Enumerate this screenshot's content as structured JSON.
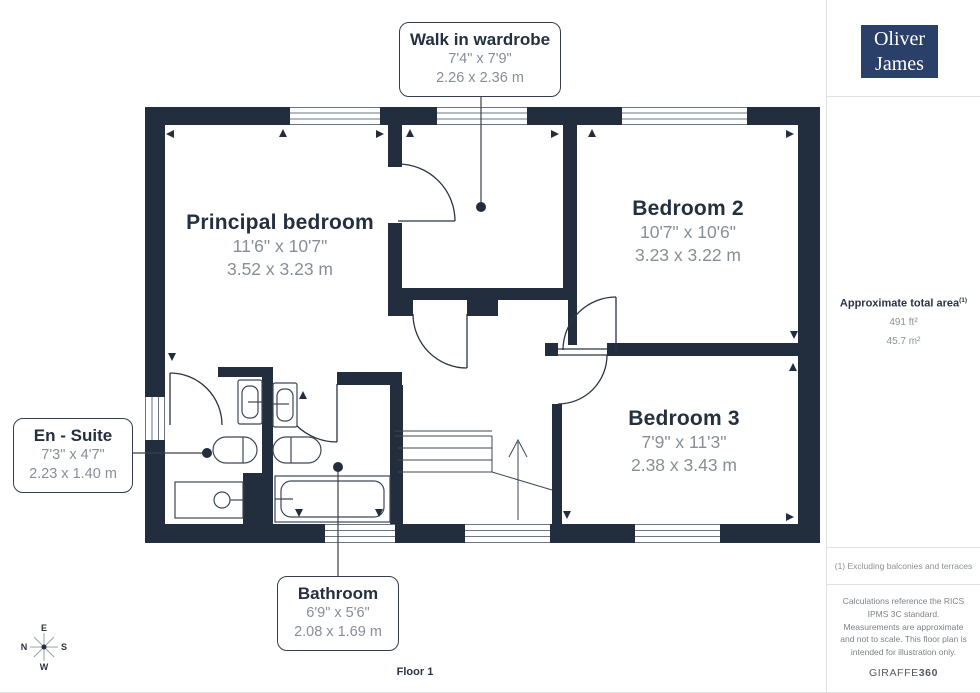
{
  "brand": {
    "line1": "Oliver",
    "line2": "James"
  },
  "rooms": {
    "principal_bedroom": {
      "name": "Principal bedroom",
      "imperial": "11'6\" x 10'7\"",
      "metric": "3.52 x 3.23 m"
    },
    "bedroom2": {
      "name": "Bedroom 2",
      "imperial": "10'7\" x 10'6\"",
      "metric": "3.23 x 3.22 m"
    },
    "bedroom3": {
      "name": "Bedroom 3",
      "imperial": "7'9\" x 11'3\"",
      "metric": "2.38 x 3.43 m"
    },
    "wardrobe": {
      "name": "Walk in wardrobe",
      "imperial": "7'4\" x 7'9\"",
      "metric": "2.26 x 2.36 m"
    },
    "ensuite": {
      "name": "En - Suite",
      "imperial": "7'3\" x 4'7\"",
      "metric": "2.23 x 1.40 m"
    },
    "bathroom": {
      "name": "Bathroom",
      "imperial": "6'9\" x 5'6\"",
      "metric": "2.08 x 1.69 m"
    }
  },
  "sidebar": {
    "area_title": "Approximate total area",
    "area_sup": "(1)",
    "area_ft": "491 ft²",
    "area_m": "45.7 m²",
    "footnote": "(1) Excluding balconies and terraces",
    "disclaimer": "Calculations reference the RICS IPMS 3C standard. Measurements are approximate and not to scale. This floor plan is intended for illustration only.",
    "brand_footer_normal": "GIRAFFE",
    "brand_footer_bold": "360"
  },
  "compass": {
    "top": "E",
    "left": "N",
    "right": "S",
    "bottom": "W"
  },
  "floor_label": "Floor 1",
  "colors": {
    "wall": "#222e3e",
    "logo_bg": "#2b4068",
    "dim_text": "#878e97",
    "title_text": "#25303f"
  }
}
